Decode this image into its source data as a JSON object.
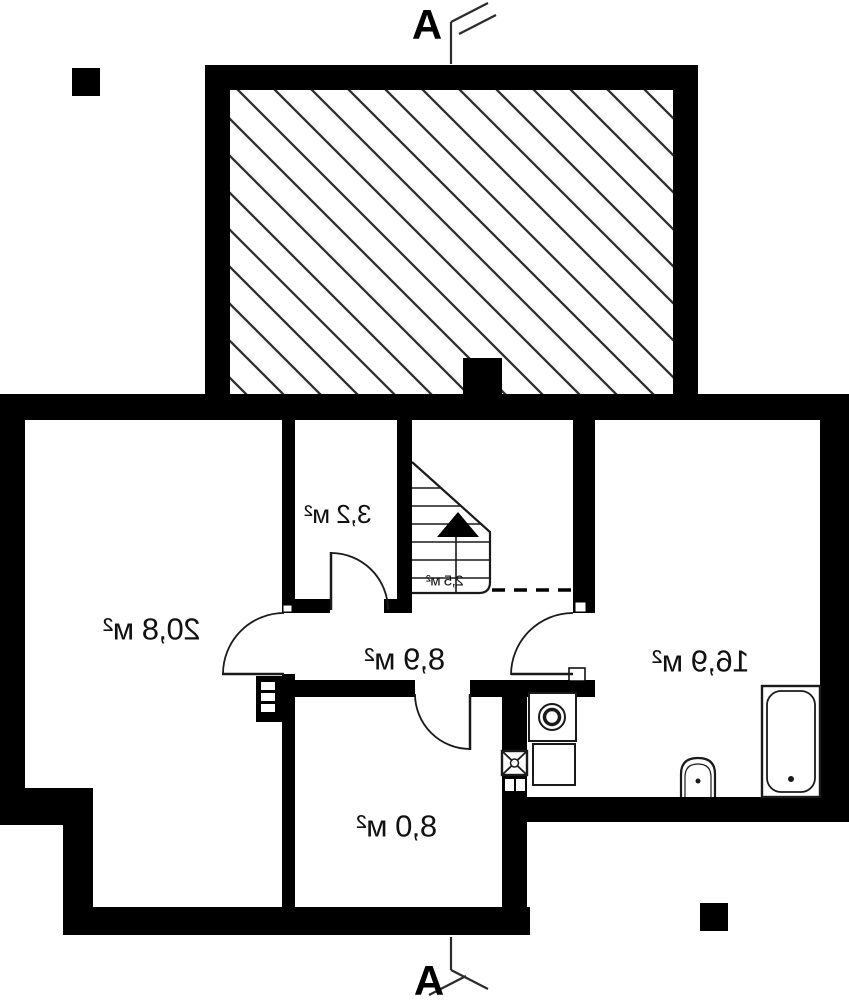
{
  "plan": {
    "section_marker_label": "A",
    "rooms": [
      {
        "id": "room-20-8",
        "area_label": "20,8 м²"
      },
      {
        "id": "room-3-2",
        "area_label": "3,2 м²"
      },
      {
        "id": "stairs-2-5",
        "area_label": "2,5 м²"
      },
      {
        "id": "hall-8-9",
        "area_label": "8,9 м²"
      },
      {
        "id": "room-16-9",
        "area_label": "16,9 м²"
      },
      {
        "id": "room-8-0",
        "area_label": "8,0 м²"
      }
    ],
    "fixtures": [
      "staircase",
      "bathtub",
      "toilet",
      "washing-machine",
      "cabinet",
      "gas-box",
      "electrical-panel",
      "chimney"
    ],
    "colors": {
      "wall": "#000000",
      "background": "#ffffff",
      "hatch_line": "#2e2e2e"
    }
  }
}
